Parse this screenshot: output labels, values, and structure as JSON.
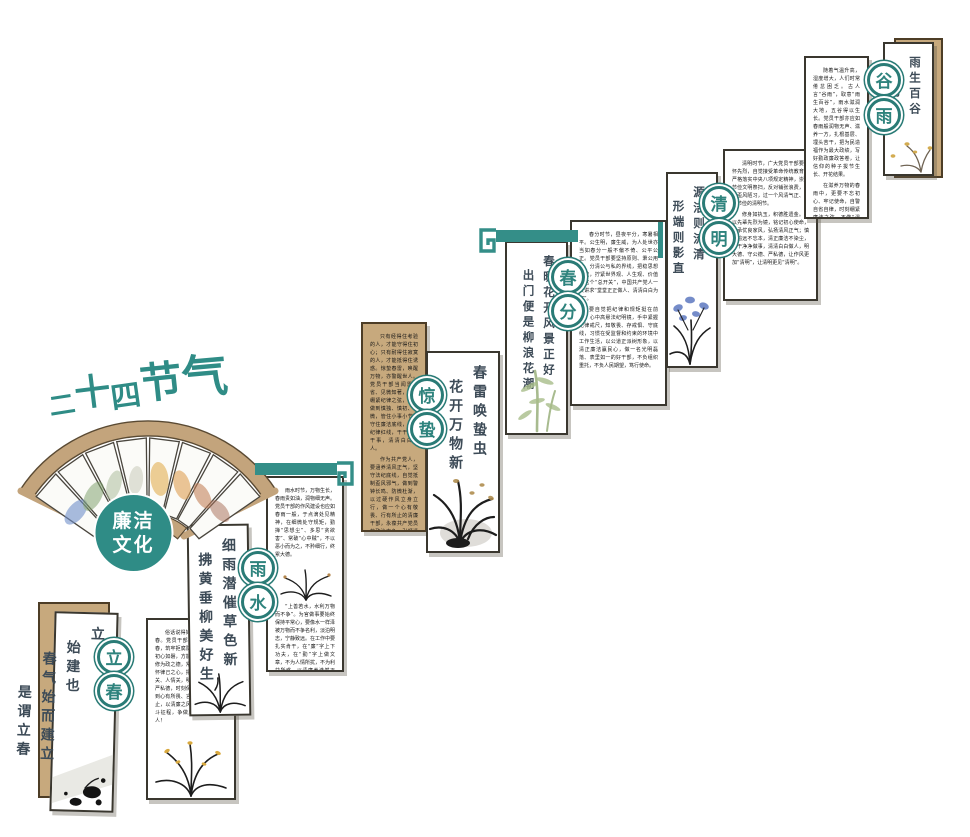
{
  "title": {
    "text": "二十四节气",
    "chars": [
      "二",
      "十",
      "四",
      "节",
      "气"
    ]
  },
  "fan": {
    "center_line1": "廉洁",
    "center_line2": "文化"
  },
  "colors": {
    "teal": "#2F8C86",
    "teal_ring": "#2A7B76",
    "tan": "#C7A97D",
    "ink": "#1D1D1D"
  },
  "terms": [
    {
      "name": "lichun",
      "circle": [
        "立",
        "春"
      ],
      "poem": [
        "立",
        "始建也",
        "春气始而建立",
        "是谓立春"
      ],
      "article": [
        "俗话说得好，一年之计在于春。党员干部要立好“廉洁”之春，筑牢拒腐防变的思想防线，初心如磐，方能行稳致远。要常修为政之德，常思贪欲之害，常怀律己之心，把好权力关、金钱关、人情关，明大德、守公德、严私德，时刻保持清醒头脑，做到心有所畏、言有所戒、行有所止，以清廉之风开启新一年的奋斗征程，争做廉洁自律的带头人！"
      ]
    },
    {
      "name": "yushui",
      "circle": [
        "雨",
        "水"
      ],
      "poem": [
        "细雨潜催草色新",
        "拂黄垂柳美好生"
      ],
      "article": [
        "雨水时节，万物生长，春雨贵如油，润物细无声。党员干部的作风建设也应如春雨一般，于点滴处见精神，在细微处守规矩，勤掸“思想尘”、多思“贪欲害”、常破“心中贼”，不以恶小而为之，不矜细行，终累大德。",
        "“上善若水，水利万物而不争”。为官做事要始终保持平常心，要像水一样泽被万物而不争名利，淡泊明志，宁静致远。在工作中要扎实肯干，在“廉”字上下功夫，在“勤”字上做文章，不为人情所扰，不为利益所惑，以清廉养浩然正气，做克己奉公、廉洁自守的明白人。"
      ]
    },
    {
      "name": "jingzhe",
      "circle": [
        "惊",
        "蛰"
      ],
      "poem": [
        "春雷唤蛰虫",
        "花开万物新"
      ],
      "article": [
        "只有经得住考验的人，才能守得住初心；只有耐得住寂寞的人，才能抵得住诱惑。惊蛰春雷，唤醒万物，亦警醒世人。党员干部当闻雷自省、见微知著，时刻绷紧纪律之弦，自觉做到慎独、慎初、慎微，管住小事小节，守住廉洁底线，不越纪律红线，干干净净干事，清清白白做人。",
        "作为共产党人，要涵养清风正气，坚守法纪底线，自觉抵制歪风邪气，做到警钟长鸣、防微杜渐，以过硬作风立身立行，做一个心有敬畏、行有所止的清廉干部，永葆共产党员的政治本色，引领清朗党风。"
      ]
    },
    {
      "name": "chunfen",
      "circle": [
        "春",
        "分"
      ],
      "poem": [
        "春暖花开风景正好",
        "出门便是柳浪花潮"
      ],
      "article": [
        "春分时节，昼夜平分，寒暑相平。公生明，廉生威，为人处世亦当如春分一般不偏不倚、公平公正。党员干部要坚持原则、秉公用权，分清公与私的界线，把稳思想之舵，拧紧世界观、人生观、价值观这个“总开关”，中国共产党人一贯讲求“堂堂正正做人、清清白白为官”。",
        "要自觉把纪律和规矩挺在前面，心中高悬法纪明镜，手中紧握纪律戒尺，知敬畏、存戒惧、守底线，习惯在受监督和约束的环境中工作生活，以公道正派树形象，以清正廉洁赢民心，做一名光明磊落、表里如一的好干部，不负组织重托，不负人民期望，笃行使命。"
      ]
    },
    {
      "name": "qingming",
      "circle": [
        "清",
        "明"
      ],
      "poem": [
        "源洁则流清",
        "形端则影直"
      ],
      "article": [
        "清明时节，广大党员干部要缅怀先烈，自觉接受革命传统教育，严格落实中央八项规定精神，崇尚节俭文明祭扫，反对铺张浪费，抵制歪风陋习，过一个风清气正、文明节俭的清明节。",
        "修身如执玉，积德胜遗金。要以先辈先烈为镜，铭记初心使命，传承优良家风，弘扬清风正气；慎终追远不忘本，清正廉洁不染尘，干干净净做事，清清白白做人，明大德、守公德、严私德，让作风更加“清明”，让清明更见“清明”。"
      ]
    },
    {
      "name": "guyu",
      "circle": [
        "谷",
        "雨"
      ],
      "poem": [
        "雨生百谷",
        "万物生长"
      ],
      "article": [
        "随着气温升高，湿度增大，人们时常倦怠困乏。古人言“谷雨”，取意“雨生百谷”，雨水滋润大地，五谷得以生长。党员干部亦应如春雨般润物无声、滋养一方，扎根基层、埋头苦干，把为民造福作为最大政绩，写好勤政廉政答卷，让信仰的种子拔节生长、开花结果。",
        "在滋养万物的春雨中，更要不忘初心、牢记使命，自警自省自律，时刻绷紧廉洁之弦，不做“温水煮青蛙”式的干部，一失足成千古恨。"
      ]
    }
  ]
}
